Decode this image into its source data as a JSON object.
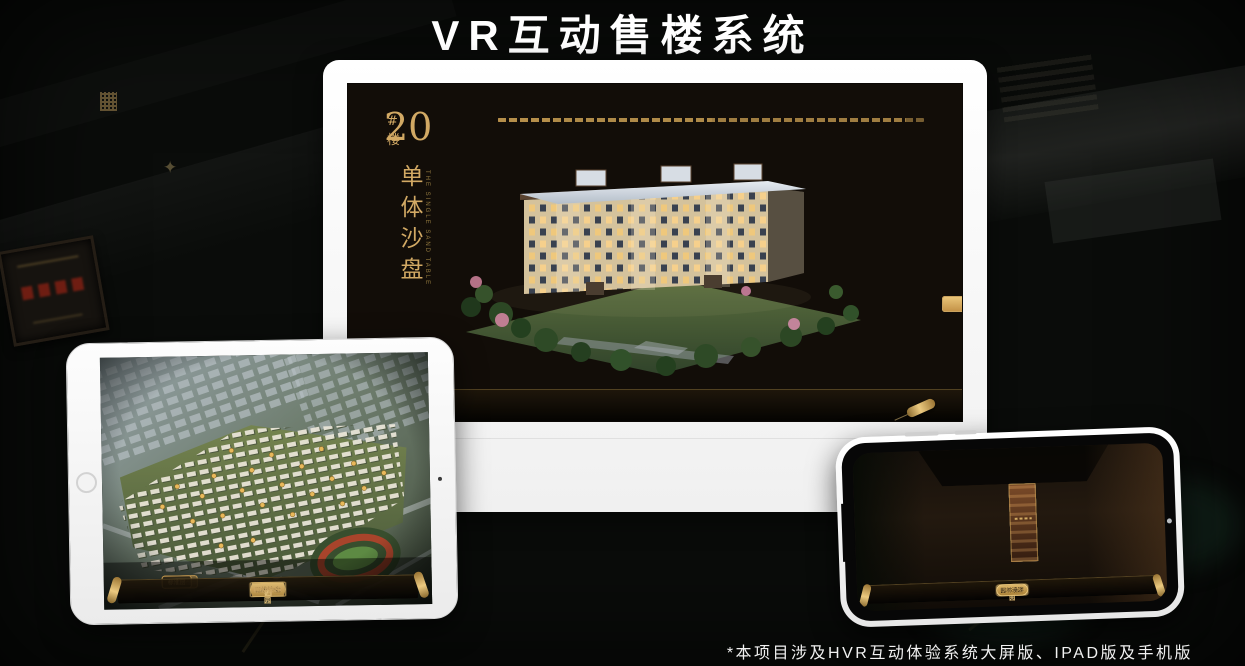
{
  "page": {
    "title": "VR互动售楼系统",
    "footnote": "*本项目涉及HVR互动体验系统大屏版、IPAD版及手机版"
  },
  "brand": {
    "logo_name": "如园",
    "accent_gold": "#CBA05C",
    "selected_gold": "#E3B765",
    "screen_bg": "#120D08"
  },
  "monitor_app": {
    "building_number": "20",
    "building_number_suffix": "#楼",
    "section_title": "单体沙盘",
    "section_title_en": "THE SINGLE SAND TABLE",
    "floor_buttons": [
      {
        "label": "3#楼",
        "selected": false
      },
      {
        "label": "6#楼",
        "selected": false
      },
      {
        "label": "8#楼",
        "selected": false
      },
      {
        "label": "20#楼",
        "selected": true
      }
    ],
    "sub_tabs": [
      {
        "label": "项目沙盘",
        "selected": false
      },
      {
        "label": "单体沙盘",
        "selected": true
      },
      {
        "label": "标准层",
        "selected": false
      }
    ],
    "nav_left": [
      {
        "label": "区位交通",
        "selected": false
      },
      {
        "label": "三维沙盘",
        "selected": true
      },
      {
        "label": "样板间VR",
        "selected": false
      }
    ],
    "nav_right": [
      {
        "label": "户型鉴赏",
        "selected": false
      },
      {
        "label": "园林漫游",
        "selected": false
      },
      {
        "label": "项目赏析",
        "selected": false
      }
    ]
  },
  "ipad_app": {
    "sub_tabs": [
      {
        "label": "项目沙盘",
        "selected": true
      },
      {
        "label": "单体沙盘",
        "selected": false
      },
      {
        "label": "标准层",
        "selected": false
      }
    ],
    "nav_left": [
      {
        "label": "区位交通",
        "selected": false
      },
      {
        "label": "三维沙盘",
        "selected": true
      },
      {
        "label": "样板间VR",
        "selected": false
      }
    ],
    "nav_right": [
      {
        "label": "户型鉴赏",
        "selected": false
      },
      {
        "label": "园林漫游",
        "selected": false
      },
      {
        "label": "项目赏析",
        "selected": false
      }
    ]
  },
  "phone_app": {
    "gallery_panel_count": 6,
    "nav_left": [
      {
        "label": "区位交通",
        "selected": false
      },
      {
        "label": "三维沙盘",
        "selected": false
      },
      {
        "label": "样板间VR",
        "selected": false
      }
    ],
    "nav_right": [
      {
        "label": "户型鉴赏",
        "selected": false
      },
      {
        "label": "园林漫游",
        "selected": true
      },
      {
        "label": "项目赏析",
        "selected": false
      }
    ]
  }
}
